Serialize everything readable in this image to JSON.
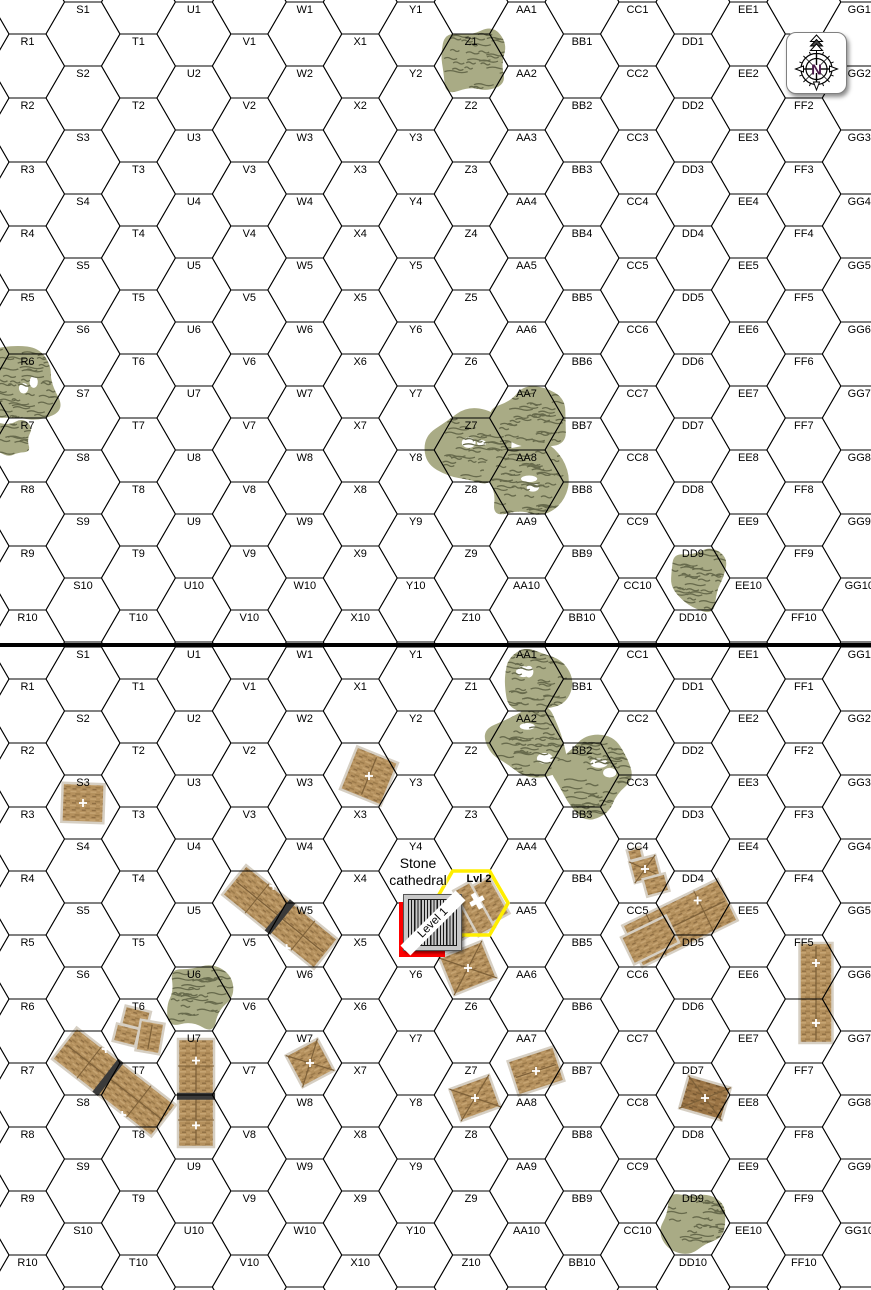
{
  "compass": {
    "letter": "N"
  },
  "grid": {
    "columns": [
      "R",
      "S",
      "T",
      "U",
      "V",
      "W",
      "X",
      "Y",
      "Z",
      "AA",
      "BB",
      "CC",
      "DD",
      "EE",
      "FF",
      "GG"
    ],
    "rows": 10,
    "boards": [
      {
        "name": "top"
      },
      {
        "name": "bottom"
      }
    ]
  },
  "annotations": {
    "stone_cathedral_lines": [
      "Stone",
      "cathedral"
    ],
    "level2_label": "Lvl 2",
    "level1_label": "Level 1"
  },
  "overlays": {
    "highlighted_hex": {
      "board": 1,
      "col": "Z",
      "row": 4
    },
    "level1_marker_hex": {
      "board": 1,
      "col": "Y",
      "row": 5
    },
    "selected_location_hex": {
      "board": 1,
      "col": "Y",
      "row": 5
    },
    "hidden_hex_labels": [
      {
        "board": 1,
        "hex": "Z4"
      },
      {
        "board": 1,
        "hex": "Z5"
      }
    ]
  },
  "terrain": {
    "woods": [
      {
        "board": 0,
        "hex": "Z1",
        "scale": 1.05,
        "dx": 3,
        "dy": -2
      },
      {
        "board": 0,
        "hex": "R6",
        "scale": 1.2,
        "dx": -6,
        "dy": -3
      },
      {
        "board": 0,
        "hex": "R7",
        "scale": 0.6,
        "dx": -16,
        "dy": -10
      },
      {
        "board": 0,
        "hex": "Z7",
        "scale": 1.2,
        "dx": 2,
        "dy": 0
      },
      {
        "board": 0,
        "hex": "AA7",
        "scale": 1.05,
        "dx": 2,
        "dy": 3
      },
      {
        "board": 0,
        "hex": "AA8",
        "scale": 1.2,
        "dx": -2,
        "dy": 0
      },
      {
        "board": 0,
        "hex": "DD9",
        "scale": 1.05,
        "dx": 3,
        "dy": 0
      },
      {
        "board": 1,
        "hex": "AA1",
        "scale": 1.1,
        "dx": 3,
        "dy": 3
      },
      {
        "board": 1,
        "hex": "AA2",
        "scale": 1.15,
        "dx": 2,
        "dy": 0
      },
      {
        "board": 1,
        "hex": "BB2",
        "scale": 1.25,
        "dx": 10,
        "dy": 4
      },
      {
        "board": 1,
        "hex": "U6",
        "scale": 1.0,
        "dx": 2,
        "dy": -2
      },
      {
        "board": 1,
        "hex": "DD9",
        "scale": 1.05,
        "dx": 2,
        "dy": -2
      }
    ],
    "buildings": [
      {
        "hex": "S3",
        "cx": 83,
        "cy": 803,
        "w": 42,
        "h": 39,
        "rot": 2,
        "roof": "flat",
        "crosses": 1
      },
      {
        "hex": "X2",
        "cx": 369,
        "cy": 776,
        "w": 44,
        "h": 46,
        "rot": 22,
        "roof": "ridge",
        "crosses": 1
      },
      {
        "hex": "U5-V5",
        "cx": 280,
        "cy": 917,
        "w": 118,
        "h": 38,
        "rot": 39,
        "roof": "long",
        "crosses": 2,
        "band": 0
      },
      {
        "hex": "T6",
        "cx": 136,
        "cy": 1018,
        "w": 26,
        "h": 19,
        "rot": 14,
        "roof": "flat",
        "crosses": 0
      },
      {
        "hex": "T7a",
        "cx": 126,
        "cy": 1035,
        "w": 23,
        "h": 18,
        "rot": 14,
        "roof": "flat",
        "crosses": 0
      },
      {
        "hex": "T7b",
        "cx": 150,
        "cy": 1037,
        "w": 24,
        "h": 31,
        "rot": 10,
        "roof": "ridge",
        "crosses": 0
      },
      {
        "hex": "S7-T8",
        "cx": 114,
        "cy": 1082,
        "w": 126,
        "h": 40,
        "rot": 38,
        "roof": "long",
        "crosses": 2,
        "band": -0.06
      },
      {
        "hex": "U7-U8",
        "cx": 196,
        "cy": 1093,
        "w": 36,
        "h": 108,
        "rot": 0,
        "roof": "long",
        "crosses": 2,
        "band": 0.03
      },
      {
        "hex": "W7",
        "cx": 310,
        "cy": 1063,
        "w": 36,
        "h": 36,
        "rot": -28,
        "roof": "pyramid",
        "crosses": 1
      },
      {
        "hex": "Z8",
        "cx": 475,
        "cy": 1098,
        "w": 42,
        "h": 34,
        "rot": -20,
        "roof": "pyramid",
        "crosses": 1
      },
      {
        "hex": "AA7",
        "cx": 536,
        "cy": 1071,
        "w": 48,
        "h": 36,
        "rot": -18,
        "roof": "ridge",
        "crosses": 1
      },
      {
        "hex": "DD4a",
        "cx": 635,
        "cy": 854,
        "w": 14,
        "h": 11,
        "rot": -15,
        "roof": "flat",
        "crosses": 0
      },
      {
        "hex": "DD4b",
        "cx": 645,
        "cy": 869,
        "w": 27,
        "h": 22,
        "rot": -15,
        "roof": "pyramid",
        "crosses": 1
      },
      {
        "hex": "DD4c",
        "cx": 656,
        "cy": 885,
        "w": 23,
        "h": 18,
        "rot": -15,
        "roof": "flat",
        "crosses": 0
      },
      {
        "hex": "CC5-DD5",
        "cx": 680,
        "cy": 923,
        "w": 106,
        "h": 46,
        "rot": -26,
        "roof": "long",
        "crosses": 2
      },
      {
        "hex": "CC5-wing",
        "cx": 650,
        "cy": 940,
        "w": 50,
        "h": 30,
        "rot": -26,
        "roof": "flat",
        "crosses": 0
      },
      {
        "hex": "FF5-FF6",
        "cx": 816,
        "cy": 993,
        "w": 33,
        "h": 100,
        "rot": 0,
        "roof": "ridge",
        "crosses": 2
      },
      {
        "hex": "DD7",
        "cx": 705,
        "cy": 1098,
        "w": 44,
        "h": 34,
        "rot": 16,
        "roof": "pyramid",
        "crosses": 1,
        "shade": "dark"
      },
      {
        "hex": "Z4-cathedral",
        "cx": 474,
        "cy": 909,
        "w": 58,
        "h": 42,
        "rot": -29,
        "roof": "cathedral",
        "crosses": 0
      },
      {
        "hex": "Z5",
        "cx": 468,
        "cy": 968,
        "w": 46,
        "h": 40,
        "rot": -22,
        "roof": "pyramid",
        "crosses": 1
      }
    ]
  },
  "colors": {
    "woods_fill": "#a9ab85",
    "woods_texture": "#676a4c",
    "building_outline": "#d6cfc3",
    "building_dark_line": "#7d6038",
    "band": "#3a3a3a",
    "grid_line": "#000000",
    "label": "#000000",
    "highlight_hex": "#ffee00",
    "selection": "#ff0000",
    "marker_bg": "#c8c8c8",
    "compass_n": "#4a1a4a"
  }
}
